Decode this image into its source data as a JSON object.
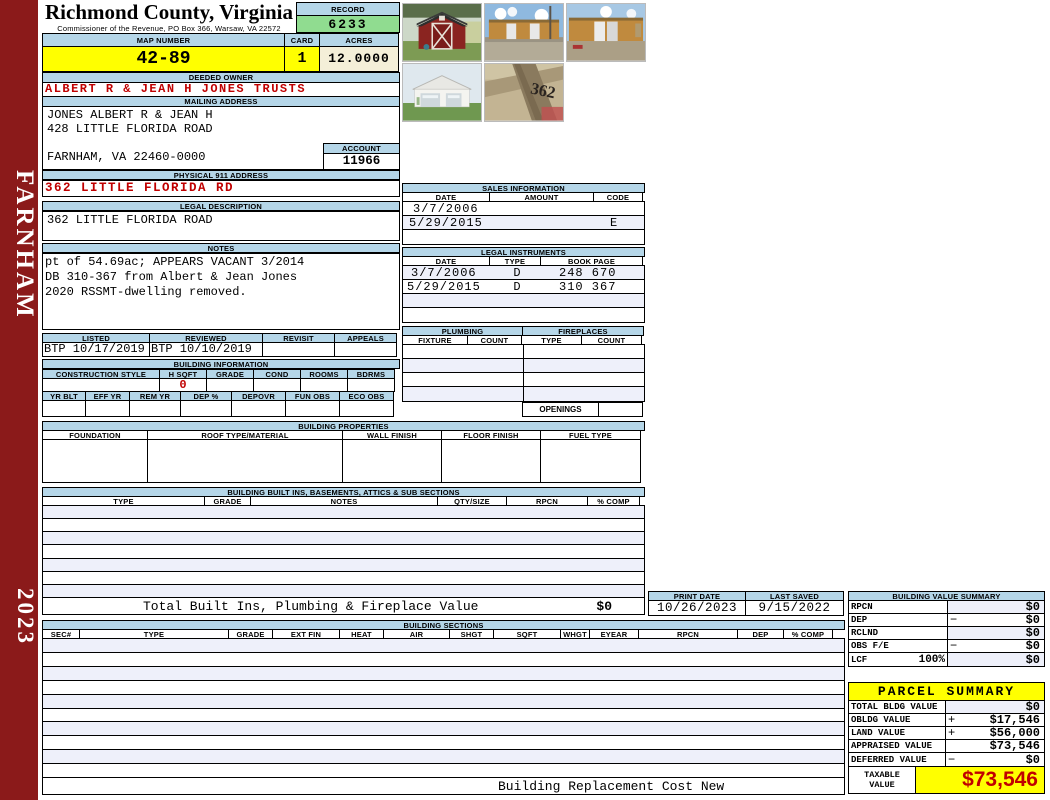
{
  "meta": {
    "county": "Richmond County, Virginia",
    "commissioner_line": "Commissioner of the Revenue, PO Box 366, Warsaw, VA 22572"
  },
  "sidebar": {
    "district": "FARNHAM",
    "year": "2023"
  },
  "header": {
    "record_label": "RECORD",
    "record": "6233",
    "map_number_label": "MAP NUMBER",
    "map_number": "42-89",
    "card_label": "CARD",
    "card": "1",
    "acres_label": "ACRES",
    "acres": "12.0000"
  },
  "owner": {
    "label": "DEEDED OWNER",
    "name": "ALBERT R & JEAN H JONES TRUSTS"
  },
  "mailing": {
    "label": "MAILING ADDRESS",
    "line1": "JONES ALBERT R & JEAN H",
    "line2": "428 LITTLE FLORIDA ROAD",
    "line3": "",
    "line4": "FARNHAM, VA 22460-0000",
    "account_label": "ACCOUNT",
    "account": "11966"
  },
  "physical_address": {
    "label": "PHYSICAL 911 ADDRESS",
    "value": "362 LITTLE FLORIDA RD"
  },
  "legal_description": {
    "label": "LEGAL DESCRIPTION",
    "value": "362 LITTLE FLORIDA ROAD"
  },
  "notes": {
    "label": "NOTES",
    "line1": "pt of 54.69ac; APPEARS VACANT 3/2014",
    "line2": "DB 310-367 from Albert & Jean Jones",
    "line3": "2020 RSSMT-dwelling removed."
  },
  "review": {
    "headers": [
      "LISTED",
      "REVIEWED",
      "REVISIT",
      "APPEALS"
    ],
    "values": [
      "BTP 10/17/2019",
      "BTP 10/10/2019",
      "",
      ""
    ]
  },
  "building_information": {
    "title": "BUILDING INFORMATION",
    "row1_headers": [
      "CONSTRUCTION STYLE",
      "H SQFT",
      "GRADE",
      "COND",
      "ROOMS",
      "BDRMS"
    ],
    "row1_values": [
      "",
      "0",
      "",
      "",
      "",
      ""
    ],
    "row2_headers": [
      "YR BLT",
      "EFF YR",
      "REM YR",
      "DEP %",
      "DEPOVR",
      "FUN OBS",
      "ECO OBS"
    ],
    "row2_values": [
      "",
      "",
      "",
      "",
      "",
      "",
      ""
    ]
  },
  "sales": {
    "title": "SALES INFORMATION",
    "headers": [
      "DATE",
      "AMOUNT",
      "CODE"
    ],
    "rows": [
      {
        "date": "3/7/2006",
        "amount": "",
        "code": ""
      },
      {
        "date": "5/29/2015",
        "amount": "",
        "code": "E"
      },
      {
        "date": "",
        "amount": "",
        "code": ""
      }
    ]
  },
  "legal_instruments": {
    "title": "LEGAL INSTRUMENTS",
    "headers": [
      "DATE",
      "TYPE",
      "BOOK PAGE"
    ],
    "rows": [
      {
        "date": "3/7/2006",
        "type": "D",
        "book": "248 670"
      },
      {
        "date": "5/29/2015",
        "type": "D",
        "book": "310 367"
      },
      {
        "date": "",
        "type": "",
        "book": ""
      },
      {
        "date": "",
        "type": "",
        "book": ""
      }
    ]
  },
  "plumbing": {
    "title": "PLUMBING",
    "headers": [
      "FIXTURE",
      "COUNT"
    ]
  },
  "fireplaces": {
    "title": "FIREPLACES",
    "headers": [
      "TYPE",
      "COUNT"
    ],
    "openings_label": "OPENINGS"
  },
  "building_properties": {
    "title": "BUILDING PROPERTIES",
    "headers": [
      "FOUNDATION",
      "ROOF TYPE/MATERIAL",
      "WALL FINISH",
      "FLOOR FINISH",
      "FUEL TYPE"
    ]
  },
  "built_ins": {
    "title": "BUILDING BUILT INS, BASEMENTS, ATTICS & SUB SECTIONS",
    "headers": [
      "TYPE",
      "GRADE",
      "NOTES",
      "QTY/SIZE",
      "RPCN",
      "% COMP"
    ],
    "total_label": "Total Built Ins, Plumbing & Fireplace Value",
    "total_value": "$0"
  },
  "print_info": {
    "print_date_label": "PRINT DATE",
    "print_date": "10/26/2023",
    "last_saved_label": "LAST SAVED",
    "last_saved": "9/15/2022"
  },
  "building_sections": {
    "title": "BUILDING SECTIONS",
    "headers": [
      "SEC#",
      "TYPE",
      "GRADE",
      "EXT FIN",
      "HEAT",
      "AIR",
      "SHGT",
      "SQFT",
      "WHGT",
      "EYEAR",
      "RPCN",
      "DEP",
      "% COMP"
    ],
    "footer": "Building Replacement Cost New"
  },
  "building_value_summary": {
    "title": "BUILDING VALUE SUMMARY",
    "rows": [
      {
        "label": "RPCN",
        "pct": "",
        "op": "",
        "value": "$0"
      },
      {
        "label": "DEP",
        "pct": "",
        "op": "−",
        "value": "$0"
      },
      {
        "label": "RCLND",
        "pct": "",
        "op": "",
        "value": "$0"
      },
      {
        "label": "OBS F/E",
        "pct": "",
        "op": "−",
        "value": "$0"
      },
      {
        "label": "LCF",
        "pct": "100%",
        "op": "",
        "value": "$0"
      }
    ]
  },
  "parcel_summary": {
    "title": "PARCEL SUMMARY",
    "rows": [
      {
        "label": "TOTAL BLDG VALUE",
        "op": "",
        "value": "$0"
      },
      {
        "label": "OBLDG VALUE",
        "op": "+",
        "value": "$17,546"
      },
      {
        "label": "LAND VALUE",
        "op": "+",
        "value": "$56,000"
      },
      {
        "label": "APPRAISED VALUE",
        "op": "",
        "value": "$73,546"
      },
      {
        "label": "DEFERRED VALUE",
        "op": "−",
        "value": "$0"
      }
    ],
    "taxable_label": "TAXABLE VALUE",
    "taxable_value": "$73,546"
  },
  "photos": [
    {
      "name": "red-barn-shed"
    },
    {
      "name": "tan-storage-buildings-1"
    },
    {
      "name": "tan-storage-buildings-2"
    },
    {
      "name": "white-garage"
    },
    {
      "name": "post-with-362-number"
    }
  ],
  "colors": {
    "header_blue": "#b5d6e8",
    "record_green": "#90dc90",
    "highlight_yellow": "#ffff00",
    "acres_cream": "#f4efd8",
    "sidebar_maroon": "#8b1a1a",
    "alert_red": "#c00000",
    "row_alt": "#eef0fa"
  }
}
